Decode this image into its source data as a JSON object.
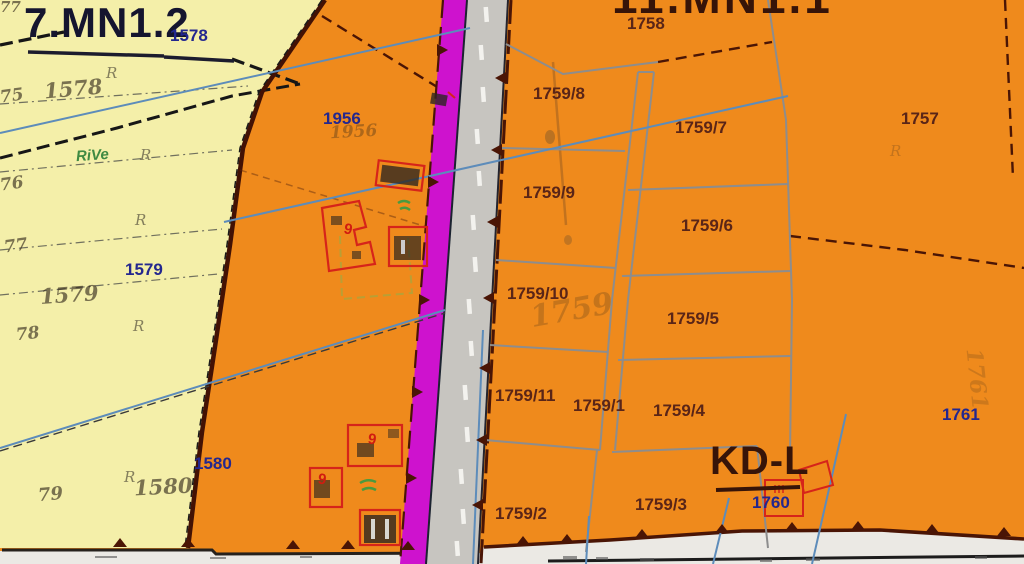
{
  "map_type": "cadastral-zoning-plan",
  "labels": {
    "zone_left": "7.MN1.2",
    "zone_top": "11.MN1.1",
    "road_class": "KD-L",
    "b1578": "1578",
    "b1579": "1579",
    "b1580": "1580",
    "b1956": "1956",
    "b1760": "1760",
    "b1761": "1761",
    "p1757": "1757",
    "p1758": "1758",
    "p1759_1": "1759/1",
    "p1759_2": "1759/2",
    "p1759_3": "1759/3",
    "p1759_4": "1759/4",
    "p1759_5": "1759/5",
    "p1759_6": "1759/6",
    "p1759_7": "1759/7",
    "p1759_8": "1759/8",
    "p1759_9": "1759/9",
    "p1759_10": "1759/10",
    "p1759_11": "1759/11",
    "h1578": "1578",
    "h1579": "1579",
    "h1580": "1580",
    "h1956": "1956",
    "h1759": "1759",
    "h1761": "1761",
    "e75": "75",
    "e76": "76",
    "e77": "77",
    "e78": "78",
    "e79": "79",
    "veg": "RiVe",
    "sym_r": "R",
    "digit9": "9"
  },
  "colors": {
    "zone_orange": "#ef8a1c",
    "zone_yellow": "#f4efa9",
    "planning_magenta": "#ce12ce",
    "road_gray": "#c7c5c0",
    "parcel_line_gray": "#8d8d8d",
    "boundary_dark_red": "#4a1505",
    "label_navy": "#23278f",
    "label_maroon": "#5a2517",
    "survey_blue": "#5d8cba",
    "building_red": "#d6241a",
    "vegetation_green": "#4a9a3f"
  }
}
